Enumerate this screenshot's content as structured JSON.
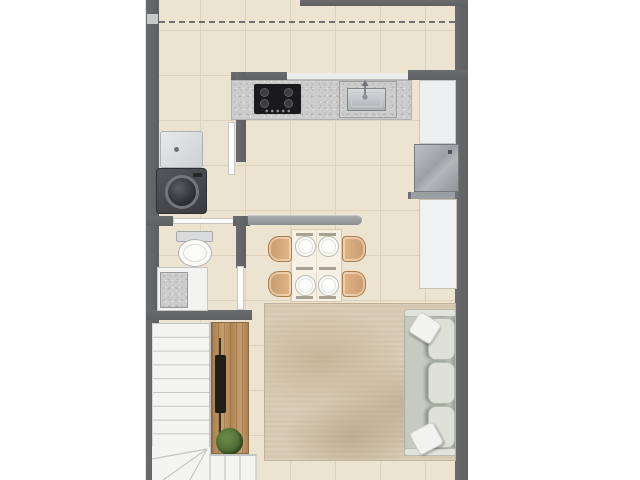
{
  "palette": {
    "background": "#ffffff",
    "floor_tile": "#ece3d1",
    "tile_grout": "#ddd2bc",
    "wall_dark": "#5e5f61",
    "wall_light": "#9b9c9e",
    "granite": "#cccccc",
    "cooktop_black": "#1a1a1d",
    "stainless": "#a3a9ac",
    "appliance_dark": "#45474a",
    "fixture_white": "#f6f6f4",
    "door_white": "#fdfdfd",
    "wood": "#b78d5a",
    "chair_tan": "#d7a87b",
    "table_cream": "#f6f1e4",
    "rug_beige": "#d5c7b0",
    "sofa_gray": "#dfe1d9",
    "plant_green": "#50703a",
    "stair_white": "#f4f4f3",
    "stair_line": "#c6c6c6"
  },
  "plan": {
    "type": "residential floor plan, top-down furnished view, no text labels",
    "rooms": [
      {
        "name": "kitchen",
        "fixtures": [
          "granite-countertop",
          "cooktop-4-burners",
          "inset-sink-with-faucet",
          "refrigerator",
          "side-counter",
          "lower-cabinet"
        ]
      },
      {
        "name": "laundry-nook",
        "fixtures": [
          "laundry-tub",
          "washing-machine"
        ]
      },
      {
        "name": "bathroom",
        "fixtures": [
          "toilet",
          "granite-vanity-sink",
          "door-leaf"
        ]
      },
      {
        "name": "dining-area",
        "fixtures": [
          "rectangular-table",
          "four-plates",
          "four-tan-chairs",
          "half-wall-peninsula"
        ]
      },
      {
        "name": "living-area",
        "fixtures": [
          "beige-area-rug",
          "three-seat-sofa",
          "two-throw-pillows",
          "wood-tv-console",
          "potted-plant"
        ]
      },
      {
        "name": "staircase",
        "fixtures": [
          "straight-run-treads",
          "winder-corner-steps",
          "lower-run-treads"
        ]
      }
    ],
    "annotations": [
      "dashed-projection-line-near-top",
      "dark-gray-exterior-walls",
      "white-page-margins-left-right"
    ]
  }
}
